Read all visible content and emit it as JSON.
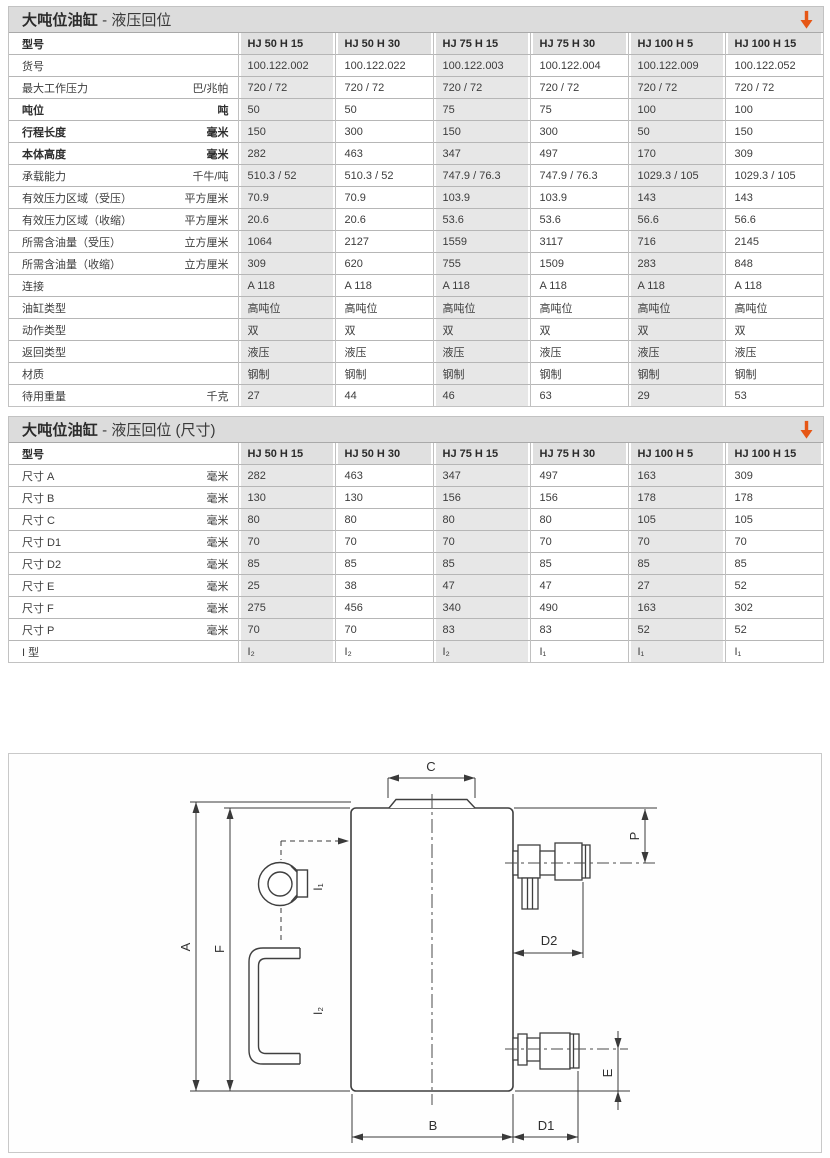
{
  "accent_orange": "#e65615",
  "table1": {
    "title_bold": "大吨位油缸",
    "title_rest": " - 液压回位",
    "header_label": "型号",
    "models": [
      "HJ 50 H 15",
      "HJ 50 H 30",
      "HJ 75 H 15",
      "HJ 75 H 30",
      "HJ 100 H 5",
      "HJ 100 H 15"
    ],
    "rows": [
      {
        "label": "货号",
        "unit": "",
        "bold": false,
        "values": [
          "100.122.002",
          "100.122.022",
          "100.122.003",
          "100.122.004",
          "100.122.009",
          "100.122.052"
        ]
      },
      {
        "label": "最大工作压力",
        "unit": "巴/兆帕",
        "bold": false,
        "values": [
          "720 / 72",
          "720 / 72",
          "720 / 72",
          "720 / 72",
          "720 / 72",
          "720 / 72"
        ]
      },
      {
        "label": "吨位",
        "unit": "吨",
        "bold": true,
        "values": [
          "50",
          "50",
          "75",
          "75",
          "100",
          "100"
        ]
      },
      {
        "label": "行程长度",
        "unit": "毫米",
        "bold": true,
        "values": [
          "150",
          "300",
          "150",
          "300",
          "50",
          "150"
        ]
      },
      {
        "label": "本体高度",
        "unit": "毫米",
        "bold": true,
        "values": [
          "282",
          "463",
          "347",
          "497",
          "170",
          "309"
        ]
      },
      {
        "label": "承载能力",
        "unit": "千牛/吨",
        "bold": false,
        "values": [
          "510.3 / 52",
          "510.3 / 52",
          "747.9 / 76.3",
          "747.9 / 76.3",
          "1029.3 / 105",
          "1029.3 / 105"
        ]
      },
      {
        "label": "有效压力区域（受压）",
        "unit": "平方厘米",
        "bold": false,
        "values": [
          "70.9",
          "70.9",
          "103.9",
          "103.9",
          "143",
          "143"
        ]
      },
      {
        "label": "有效压力区域（收缩）",
        "unit": "平方厘米",
        "bold": false,
        "values": [
          "20.6",
          "20.6",
          "53.6",
          "53.6",
          "56.6",
          "56.6"
        ]
      },
      {
        "label": "所需含油量（受压）",
        "unit": "立方厘米",
        "bold": false,
        "values": [
          "1064",
          "2127",
          "1559",
          "3117",
          "716",
          "2145"
        ]
      },
      {
        "label": "所需含油量（收缩）",
        "unit": "立方厘米",
        "bold": false,
        "values": [
          "309",
          "620",
          "755",
          "1509",
          "283",
          "848"
        ]
      },
      {
        "label": "连接",
        "unit": "",
        "bold": false,
        "values": [
          "A 118",
          "A 118",
          "A 118",
          "A 118",
          "A 118",
          "A 118"
        ]
      },
      {
        "label": "油缸类型",
        "unit": "",
        "bold": false,
        "values": [
          "高吨位",
          "高吨位",
          "高吨位",
          "高吨位",
          "高吨位",
          "高吨位"
        ]
      },
      {
        "label": "动作类型",
        "unit": "",
        "bold": false,
        "values": [
          "双",
          "双",
          "双",
          "双",
          "双",
          "双"
        ]
      },
      {
        "label": "返回类型",
        "unit": "",
        "bold": false,
        "values": [
          "液压",
          "液压",
          "液压",
          "液压",
          "液压",
          "液压"
        ]
      },
      {
        "label": "材质",
        "unit": "",
        "bold": false,
        "values": [
          "钢制",
          "钢制",
          "钢制",
          "钢制",
          "钢制",
          "钢制"
        ]
      },
      {
        "label": "待用重量",
        "unit": "千克",
        "bold": false,
        "values": [
          "27",
          "44",
          "46",
          "63",
          "29",
          "53"
        ]
      }
    ]
  },
  "table2": {
    "title_bold": "大吨位油缸",
    "title_rest": " - 液压回位 (尺寸)",
    "header_label": "型号",
    "models": [
      "HJ 50 H 15",
      "HJ 50 H 30",
      "HJ 75 H 15",
      "HJ 75 H 30",
      "HJ 100 H 5",
      "HJ 100 H 15"
    ],
    "rows": [
      {
        "label": "尺寸 A",
        "unit": "毫米",
        "bold": false,
        "values": [
          "282",
          "463",
          "347",
          "497",
          "163",
          "309"
        ]
      },
      {
        "label": "尺寸 B",
        "unit": "毫米",
        "bold": false,
        "values": [
          "130",
          "130",
          "156",
          "156",
          "178",
          "178"
        ]
      },
      {
        "label": "尺寸 C",
        "unit": "毫米",
        "bold": false,
        "values": [
          "80",
          "80",
          "80",
          "80",
          "105",
          "105"
        ]
      },
      {
        "label": "尺寸 D1",
        "unit": "毫米",
        "bold": false,
        "values": [
          "70",
          "70",
          "70",
          "70",
          "70",
          "70"
        ]
      },
      {
        "label": "尺寸 D2",
        "unit": "毫米",
        "bold": false,
        "values": [
          "85",
          "85",
          "85",
          "85",
          "85",
          "85"
        ]
      },
      {
        "label": "尺寸 E",
        "unit": "毫米",
        "bold": false,
        "values": [
          "25",
          "38",
          "47",
          "47",
          "27",
          "52"
        ]
      },
      {
        "label": "尺寸 F",
        "unit": "毫米",
        "bold": false,
        "values": [
          "275",
          "456",
          "340",
          "490",
          "163",
          "302"
        ]
      },
      {
        "label": "尺寸 P",
        "unit": "毫米",
        "bold": false,
        "values": [
          "70",
          "70",
          "83",
          "83",
          "52",
          "52"
        ]
      },
      {
        "label": "I 型",
        "unit": "",
        "bold": false,
        "values": [
          "I₂",
          "I₂",
          "I₂",
          "I₁",
          "I₁",
          "I₁"
        ]
      }
    ]
  },
  "drawing": {
    "labels": {
      "A": "A",
      "F": "F",
      "C": "C",
      "P": "P",
      "D2": "D2",
      "E": "E",
      "B": "B",
      "D1": "D1",
      "I1": "I₁",
      "I2": "I₂"
    }
  }
}
